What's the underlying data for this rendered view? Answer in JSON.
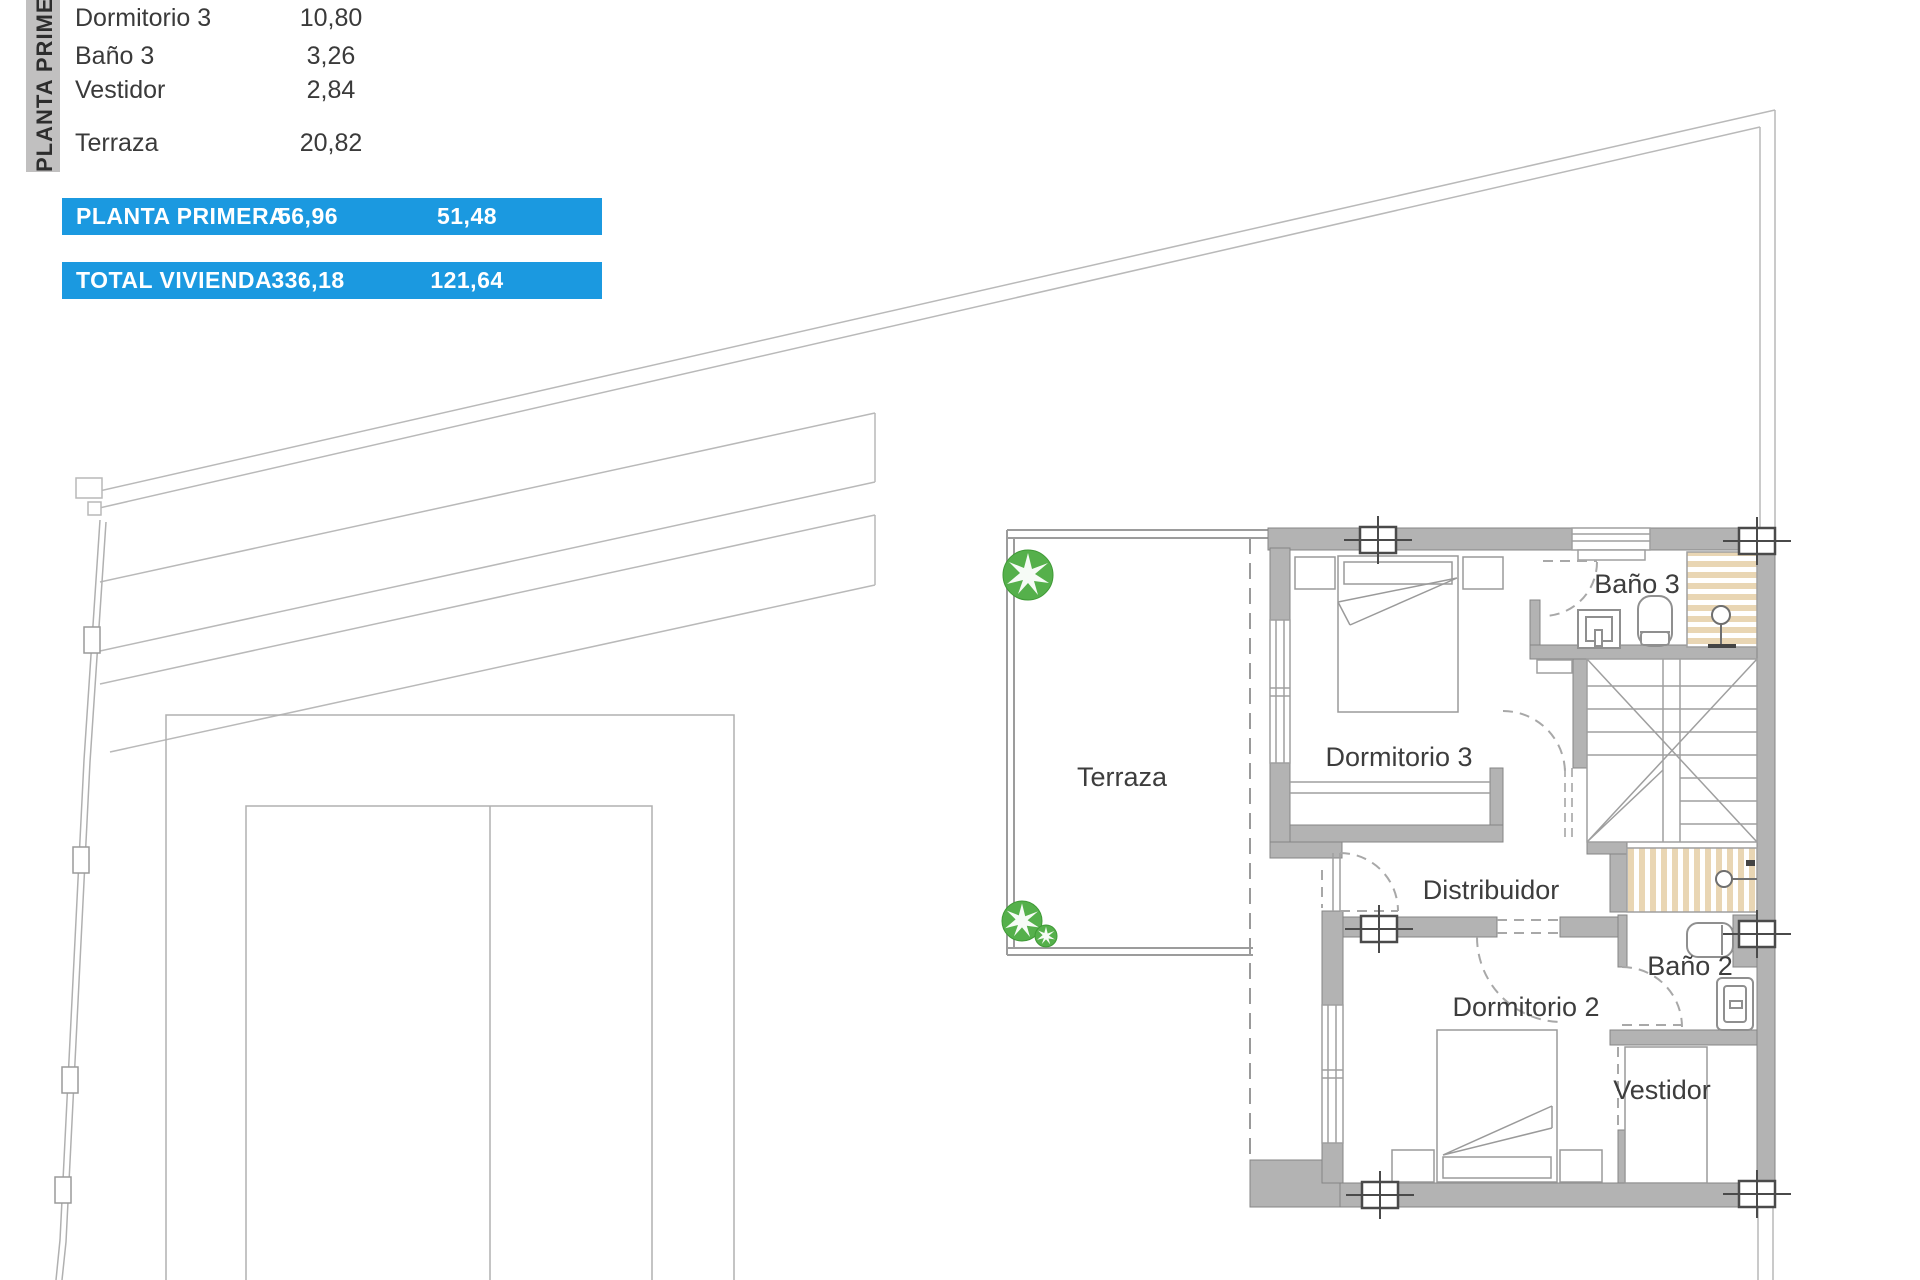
{
  "sidebar": {
    "title": "PLANTA PRIMERA"
  },
  "room_list": {
    "rows": [
      {
        "label": "Dormitorio 3",
        "value": "10,80"
      },
      {
        "label": "Baño 3",
        "value": "3,26"
      },
      {
        "label": "Vestidor",
        "value": "2,84"
      },
      {
        "label": "Terraza",
        "value": "20,82"
      }
    ]
  },
  "summary_bars": {
    "rows": [
      {
        "label": "PLANTA PRIMERA",
        "built_area": "56,96",
        "useful_area": "51,48"
      },
      {
        "label": "TOTAL VIVIENDA",
        "built_area": "336,18",
        "useful_area": "121,64"
      }
    ]
  },
  "floor_plan": {
    "labels": {
      "terraza": "Terraza",
      "dormitorio3": "Dormitorio 3",
      "bano3": "Baño 3",
      "distribuidor": "Distribuidor",
      "dormitorio2": "Dormitorio 2",
      "bano2": "Baño 2",
      "vestidor": "Vestidor"
    }
  },
  "colors": {
    "accent_blue": "#1b99e0",
    "sidebar_gray": "#c1c0c0",
    "wall_gray": "#b3b3b3",
    "tile_tan": "#e9d6b4",
    "tree_green": "#55b04b",
    "line_gray": "#a8a8a8"
  }
}
